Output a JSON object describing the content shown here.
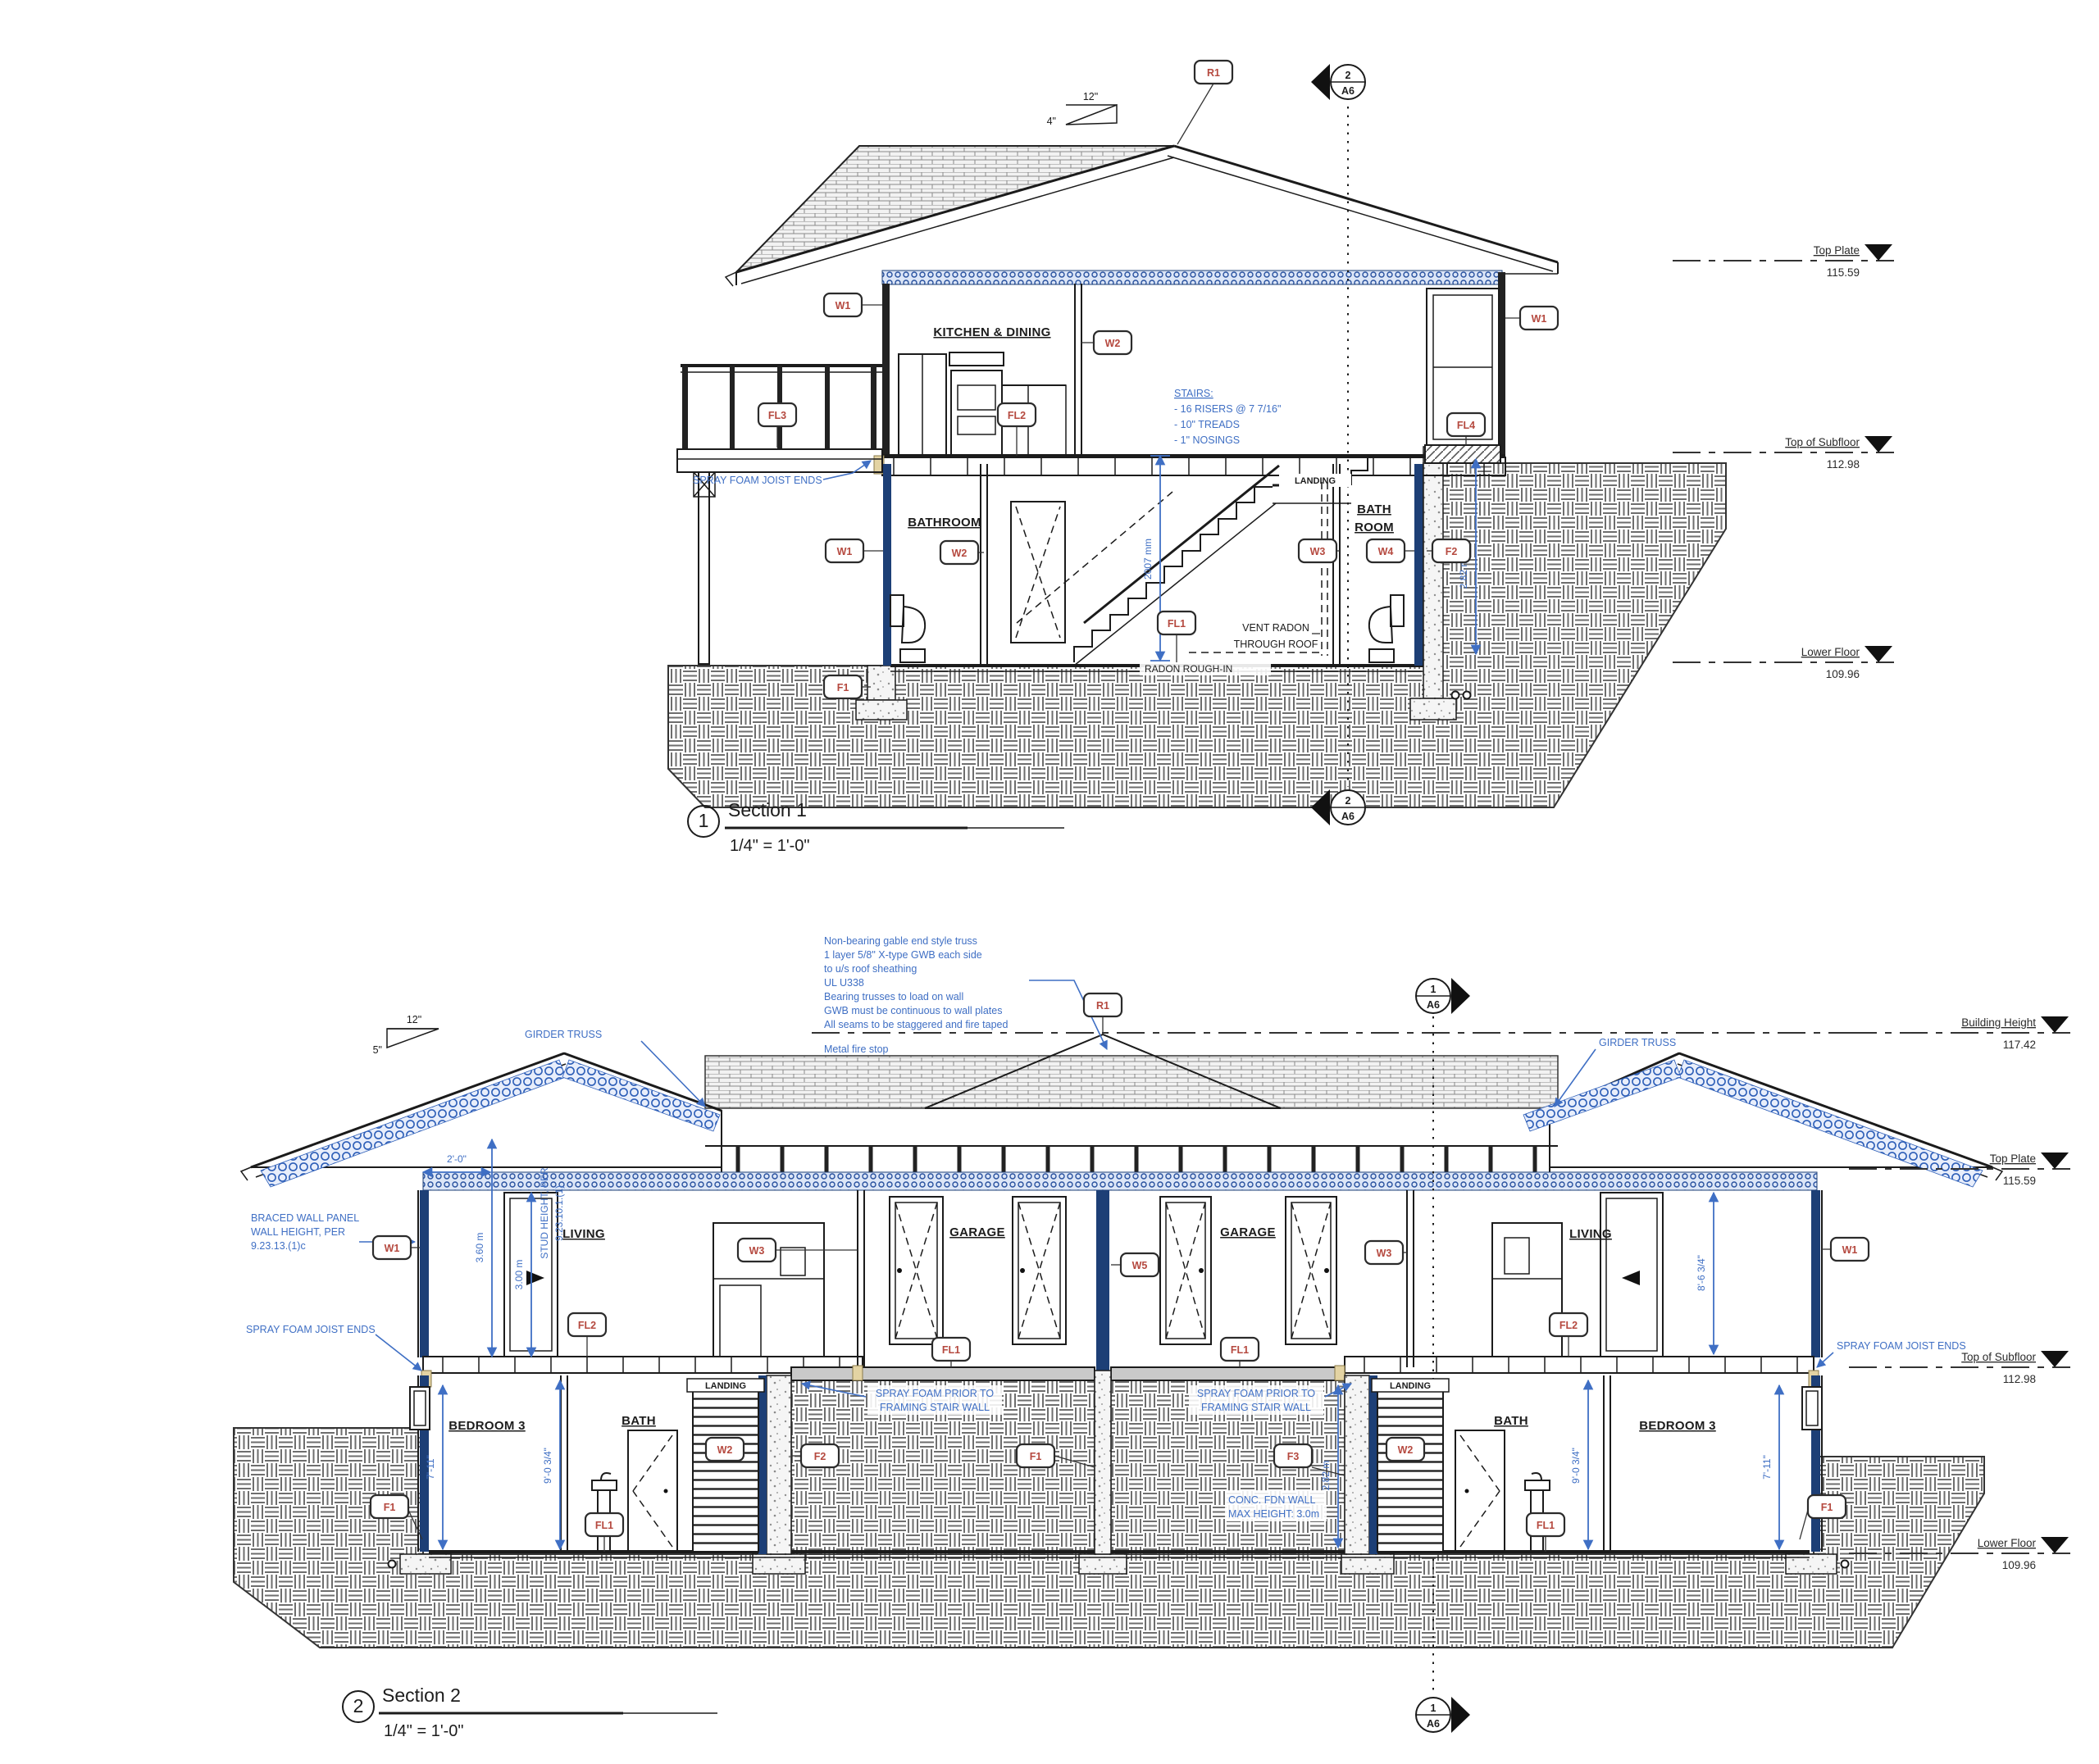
{
  "colors": {
    "annotation_blue": "#3f6fc4",
    "insulation_navy": "#1d3f76",
    "tag_red": "#b5493f",
    "ink": "#1b1b1b",
    "paper": "#ffffff"
  },
  "s1": {
    "no": "1",
    "title": "Section 1",
    "scale": "1/4\" = 1'-0\"",
    "marker": {
      "n": "2",
      "s": "A6"
    },
    "slope_rise": "12\"",
    "slope_run": "4\"",
    "rooms": {
      "kitchen": "KITCHEN & DINING",
      "bathroom": "BATHROOM",
      "bath1": "BATH",
      "bath2": "ROOM",
      "landing": "LANDING"
    },
    "stairs": [
      "STAIRS:",
      "- 16 RISERS @ 7 7/16\"",
      "- 10\" TREADS",
      "- 1\" NOSINGS"
    ],
    "spray": "SPRAY FOAM JOIST ENDS",
    "vent": [
      "VENT RADON",
      "THROUGH ROOF"
    ],
    "radon": "RADON ROUGH-IN",
    "dims": {
      "stair_headroom": "2007 mm",
      "fdn_height": "2.82 m"
    },
    "levels": [
      {
        "label": "Top Plate",
        "value": "115.59"
      },
      {
        "label": "Top of Subfloor",
        "value": "112.98"
      },
      {
        "label": "Lower Floor",
        "value": "109.96"
      }
    ],
    "tags": {
      "r1": "R1",
      "w1": "W1",
      "w2": "W2",
      "w3": "W3",
      "w4": "W4",
      "f1": "F1",
      "f2": "F2",
      "fl1": "FL1",
      "fl2": "FL2",
      "fl3": "FL3",
      "fl4": "FL4"
    }
  },
  "s2": {
    "no": "2",
    "title": "Section 2",
    "scale": "1/4\" = 1'-0\"",
    "marker": {
      "n": "1",
      "s": "A6"
    },
    "slope_rise": "12\"",
    "slope_run": "5\"",
    "truss_note": [
      "Non-bearing gable end style truss",
      "1 layer 5/8\" X-type GWB each side",
      "to u/s roof sheathing",
      "UL U338",
      "Bearing trusses to load on wall",
      "GWB must be continuous to wall plates",
      "All seams to be staggered and fire taped"
    ],
    "fire_stop": "Metal fire stop",
    "girder": "GIRDER TRUSS",
    "braced": [
      "BRACED WALL PANEL",
      "WALL HEIGHT, PER",
      "9.23.13.(1)c"
    ],
    "spray": "SPRAY FOAM JOIST ENDS",
    "spray_stair": [
      "SPRAY FOAM PRIOR TO",
      "FRAMING STAIR WALL"
    ],
    "conc_note": [
      "CONC. FDN WALL",
      "MAX HEIGHT: 3.0m"
    ],
    "stud_note": [
      "STUD HEIGHT, PER",
      "9.23.10.1.(1)"
    ],
    "rooms": {
      "living": "LIVING",
      "garage": "GARAGE",
      "bed": "BEDROOM 3",
      "bath": "BATH",
      "landing": "LANDING"
    },
    "dims": {
      "overhang": "2'-0\"",
      "m360": "3.60 m",
      "m300": "3.00 m",
      "h711": "7'-11\"",
      "h863": "8'-6 3/4\"",
      "h903": "9'-0 3/4\"",
      "m282": "2.82 m"
    },
    "levels": [
      {
        "label": "Building Height",
        "value": "117.42"
      },
      {
        "label": "Top Plate",
        "value": "115.59"
      },
      {
        "label": "Top of Subfloor",
        "value": "112.98"
      },
      {
        "label": "Lower Floor",
        "value": "109.96"
      }
    ],
    "tags": {
      "r1": "R1",
      "w1": "W1",
      "w2": "W2",
      "w3": "W3",
      "w5": "W5",
      "f1": "F1",
      "f2": "F2",
      "f3": "F3",
      "fl1": "FL1",
      "fl2": "FL2"
    }
  }
}
